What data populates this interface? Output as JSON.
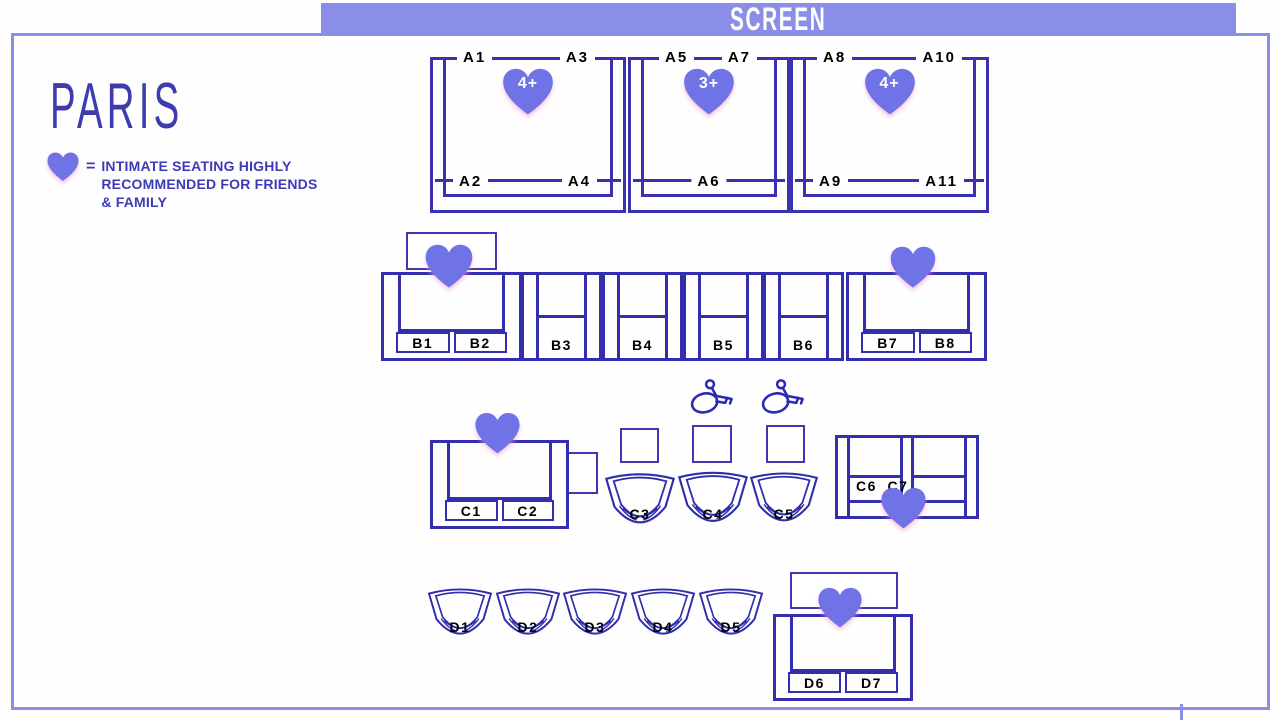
{
  "screen_banner": {
    "label": "SCREEN"
  },
  "venue": {
    "name": "PARIS"
  },
  "legend": {
    "equals": "=",
    "lines": [
      "INTIMATE SEATING HIGHLY",
      "RECOMMENDED FOR FRIENDS",
      "& FAMILY"
    ]
  },
  "icons": {
    "heart": "heart-icon",
    "wheelchair": "wheelchair-icon"
  },
  "colors": {
    "accent_periwinkle": "#8b8ee7",
    "seat_outline": "#322eae",
    "heart_fill": "#6f73e6",
    "legend_text": "#3b3bb5",
    "seat_label": "#000000",
    "screen_text": "#ffffff"
  },
  "booths": [
    {
      "badge": "4+",
      "top_left": "A1",
      "top_right": "A3",
      "bottom_left": "A2",
      "bottom_right": "A4"
    },
    {
      "badge": "3+",
      "top_left": "A5",
      "top_right": "A7",
      "bottom_center": "A6"
    },
    {
      "badge": "4+",
      "top_left": "A8",
      "top_right": "A10",
      "bottom_left": "A9",
      "bottom_right": "A11"
    }
  ],
  "row_b": {
    "loveseat_left": [
      "B1",
      "B2"
    ],
    "singles": [
      "B3",
      "B4",
      "B5",
      "B6"
    ],
    "loveseat_right": [
      "B7",
      "B8"
    ]
  },
  "row_c": {
    "loveseat": [
      "C1",
      "C2"
    ],
    "tubs": [
      "C3",
      "C4",
      "C5"
    ],
    "recliners": [
      "C6",
      "C7"
    ]
  },
  "row_d": {
    "tubs": [
      "D1",
      "D2",
      "D3",
      "D4",
      "D5"
    ],
    "loveseat": [
      "D6",
      "D7"
    ]
  }
}
